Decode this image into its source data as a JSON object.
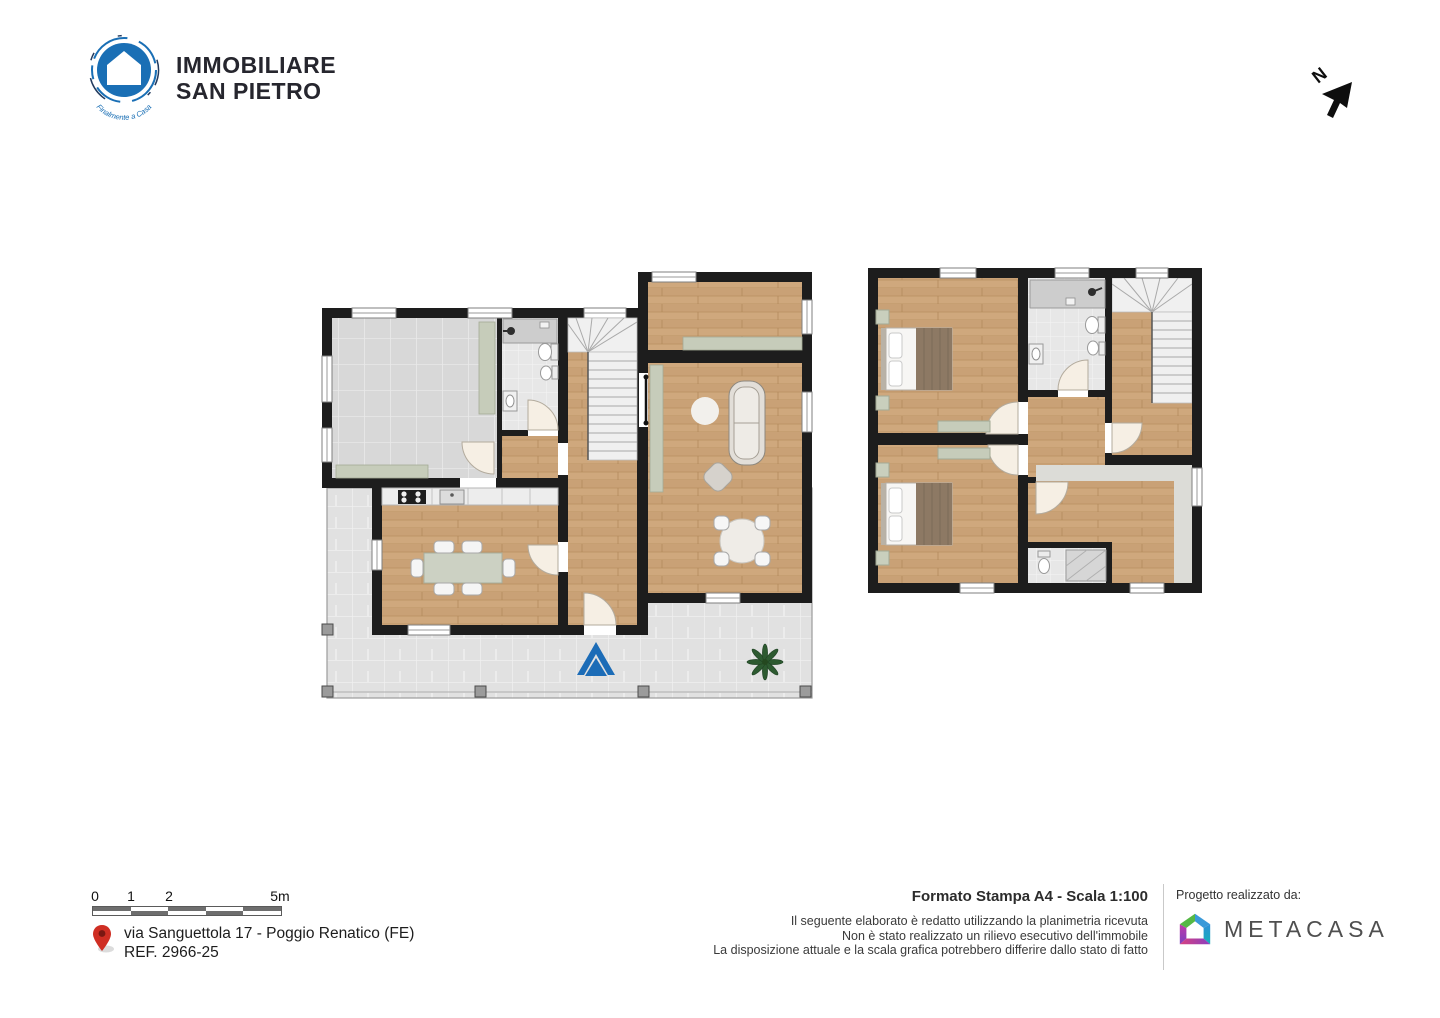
{
  "logo": {
    "name_line1": "IMMOBILIARE",
    "name_line2": "SAN PIETRO",
    "tagline": "Finalmente a Casa"
  },
  "compass": {
    "north_label": "N"
  },
  "scale_bar": {
    "label_0": "0",
    "label_1": "1",
    "label_2": "2",
    "label_5": "5m"
  },
  "location": {
    "address": "via Sanguettola 17 - Poggio Renatico (FE)",
    "reference": "REF. 2966-25"
  },
  "print": {
    "format": "Formato Stampa A4 - Scala 1:100",
    "disclaimer_line1": "Il seguente elaborato è redatto utilizzando la planimetria ricevuta",
    "disclaimer_line2": "Non è stato realizzato un rilievo esecutivo dell'immobile",
    "disclaimer_line3": "La disposizione attuale e la scala grafica potrebbero differire dallo stato di fatto"
  },
  "credit": {
    "label": "Progetto realizzato da:",
    "brand": "METACASA"
  },
  "colors": {
    "wall": "#1d1d1d",
    "wood_floor": "#cfa87d",
    "tile_floor": "#d8d8d8",
    "terrace_floor": "#e1e1e1",
    "bath_floor": "#e7e7e7",
    "sage_furniture": "#c6ccba",
    "entrance_arrow_blue": "#1c6cb7",
    "logo_blue": "#1a6fb5",
    "pin_red": "#cf2e23",
    "plant_green": "#2d5a30",
    "brand_text_gray": "#4f4f4f"
  }
}
